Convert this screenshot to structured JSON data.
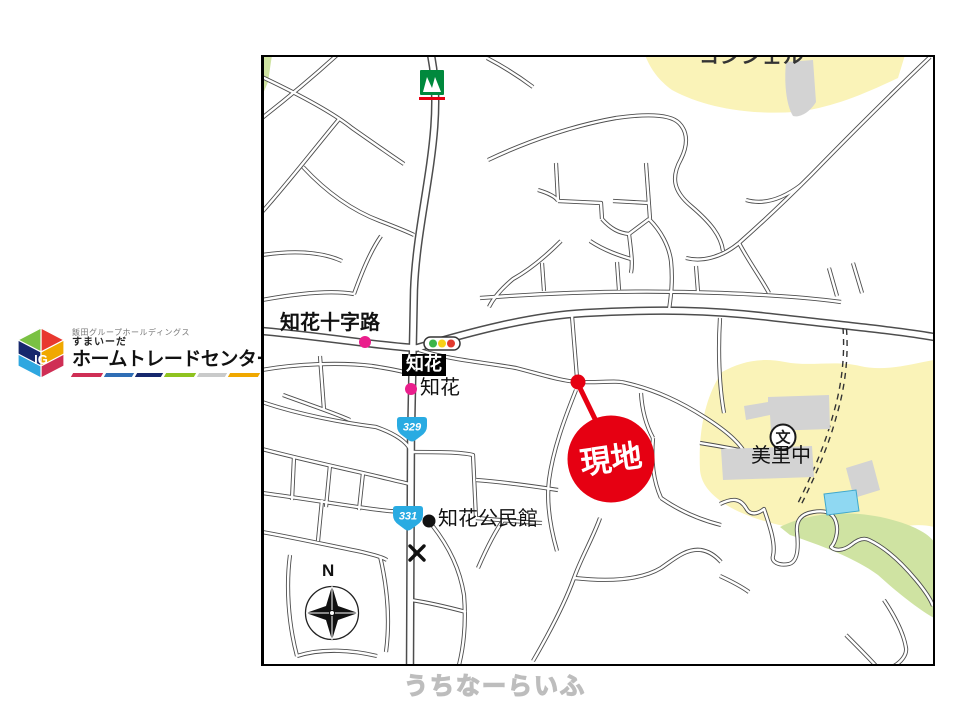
{
  "logo": {
    "group_name": "飯田グループホールディングス",
    "brand": "すまいーだ",
    "company": "ホームトレードセンター",
    "cube_initials": "IG"
  },
  "map": {
    "labels": {
      "concierge": "コンシェル",
      "crossing": "知花十字路",
      "station_box": "知花",
      "bus_stop": "知花",
      "route_329": "329",
      "route_331": "331",
      "community_center": "知花公民館",
      "school": "美里中",
      "school_symbol": "文",
      "site": "現地",
      "north": "N"
    },
    "colors": {
      "site_red": "#e60012",
      "poi_pink": "#ea1e8c",
      "route_blue": "#29abe2",
      "school_area_yellow": "#faf3b8",
      "park_green": "#cfe3a2",
      "pool_blue": "#8fd8f2",
      "road_casing": "#4d4d4d",
      "traffic_green": "#3cb54a",
      "traffic_yellow": "#f7d117",
      "traffic_red": "#e23a2e",
      "store_green": "#00893d"
    }
  },
  "watermark": "うちなーらいふ"
}
